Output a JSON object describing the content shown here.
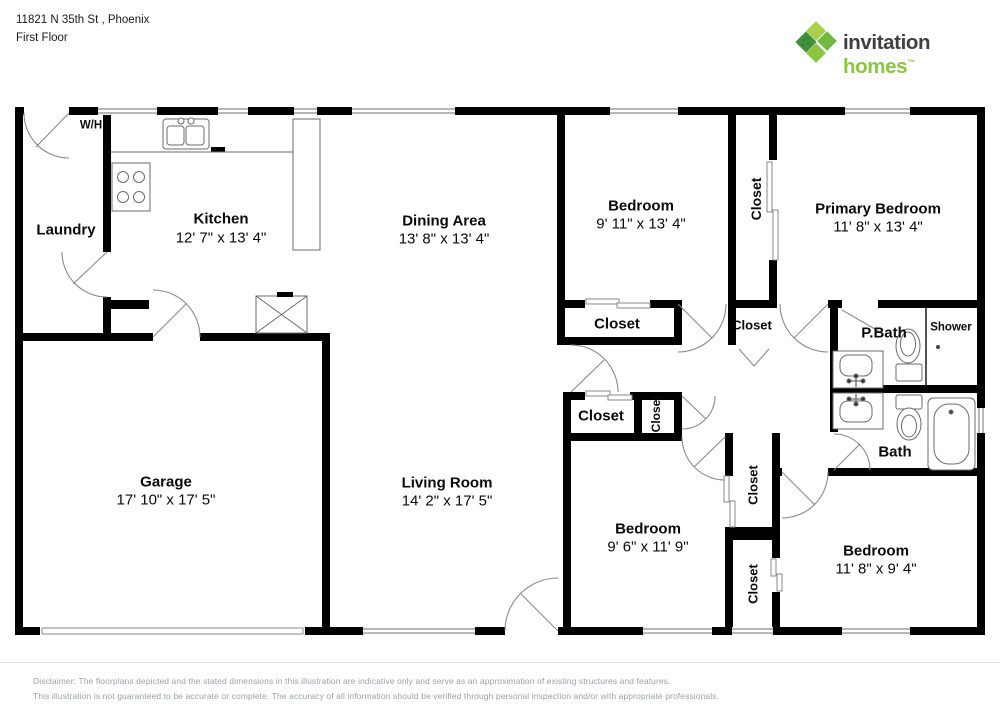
{
  "header": {
    "address": "11821 N 35th St , Phoenix",
    "floor_label": "First Floor"
  },
  "logo": {
    "brand_word1": "invitation",
    "brand_word2": "homes",
    "trademark": "™",
    "colors": {
      "dark_text": "#3f3f41",
      "green_text": "#8cc63f",
      "square_top": "#a8cf4a",
      "square_left": "#3f8f3e",
      "square_right": "#72b843",
      "square_bottom": "#8cc63f"
    }
  },
  "floorplan": {
    "wall_color": "#000000",
    "rooms": {
      "water_heater": {
        "name": "W/H"
      },
      "laundry": {
        "name": "Laundry"
      },
      "kitchen": {
        "name": "Kitchen",
        "dims": "12' 7\" x 13' 4\""
      },
      "dining_area": {
        "name": "Dining Area",
        "dims": "13' 8\" x 13' 4\""
      },
      "bedroom_top": {
        "name": "Bedroom",
        "dims": "9' 11\" x 13' 4\""
      },
      "primary_bedroom": {
        "name": "Primary Bedroom",
        "dims": "11' 8\" x 13' 4\""
      },
      "primary_bath": {
        "name": "P.Bath"
      },
      "shower": {
        "name": "Shower"
      },
      "bath": {
        "name": "Bath"
      },
      "garage": {
        "name": "Garage",
        "dims": "17' 10\" x 17' 5\""
      },
      "living_room": {
        "name": "Living Room",
        "dims": "14' 2\" x 17' 5\""
      },
      "bedroom_middle": {
        "name": "Bedroom",
        "dims": "9' 6\" x 11' 9\""
      },
      "bedroom_bottom": {
        "name": "Bedroom",
        "dims": "11' 8\" x 9' 4\""
      }
    },
    "closets": [
      "Closet",
      "Closet",
      "Closet",
      "Closet",
      "Closet",
      "Closet",
      "Closet"
    ]
  },
  "disclaimer": {
    "line1": "Disclaimer: The floorplans depicted and the stated dimensions in this illustration are indicative only and serve as an approximation of existing structures and features.",
    "line2": "This illustration is not guaranteed to be accurate or complete. The accuracy of all information should be verified through personal inspection and/or with appropriate professionals."
  }
}
